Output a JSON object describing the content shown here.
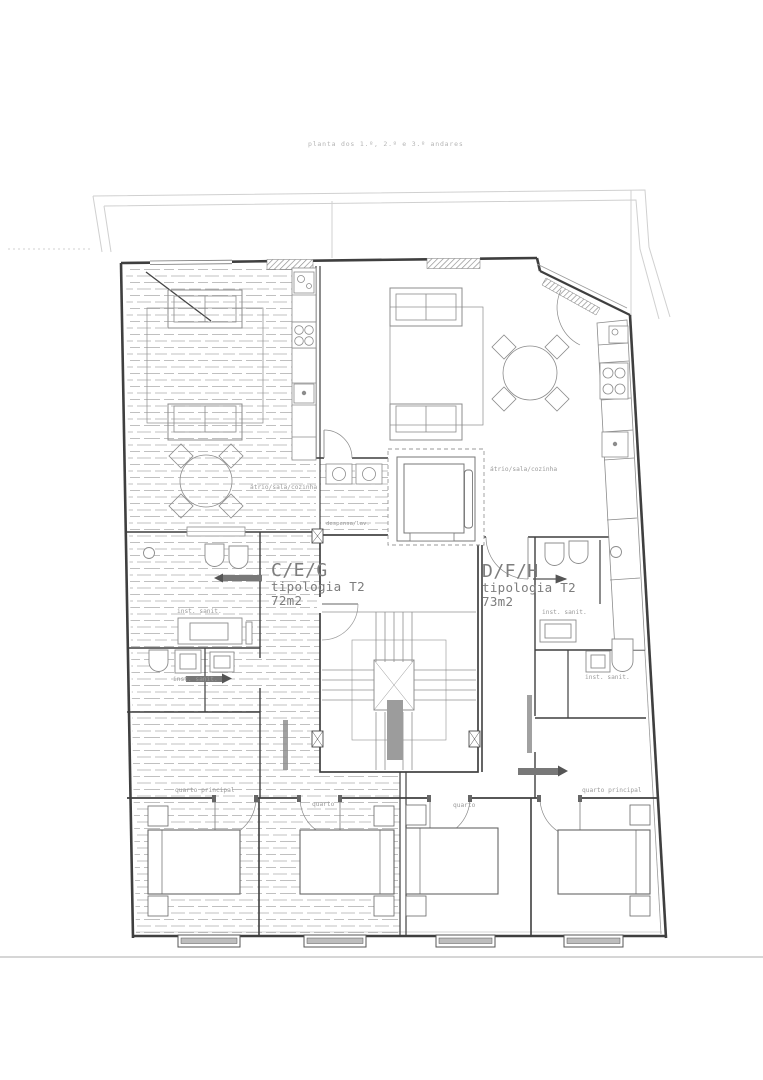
{
  "title": "planta dos 1.º, 2.º e 3.º andares",
  "units": {
    "left": {
      "code": "C/E/G",
      "typology": "tipologia T2",
      "area": "72m2"
    },
    "right": {
      "code": "D/F/H",
      "typology": "tipologia T2",
      "area": "73m2"
    }
  },
  "rooms": {
    "left_living": "átrio/sala/cozinha",
    "right_living": "átrio/sala/cozinha",
    "pantry": "despensa/lav.",
    "left_bath_upper": "inst. sanit.",
    "left_bath_lower": "inst. sanit.",
    "right_bath_upper": "inst. sanit.",
    "right_bath_lower": "inst. sanit.",
    "left_master": "quarto principal",
    "left_bedroom": "quarto",
    "right_bedroom": "quarto",
    "right_master": "quarto principal"
  },
  "colors": {
    "wall": "#3f3f3f",
    "furniture": "#8c8c8c",
    "hatch": "#b0b0b0",
    "context": "#d0d0d0",
    "stair_fill": "#9c9c9c",
    "label_text": "#9b9b9b",
    "unit_text": "#7d7d7d",
    "title_text": "#b5b5b5"
  }
}
